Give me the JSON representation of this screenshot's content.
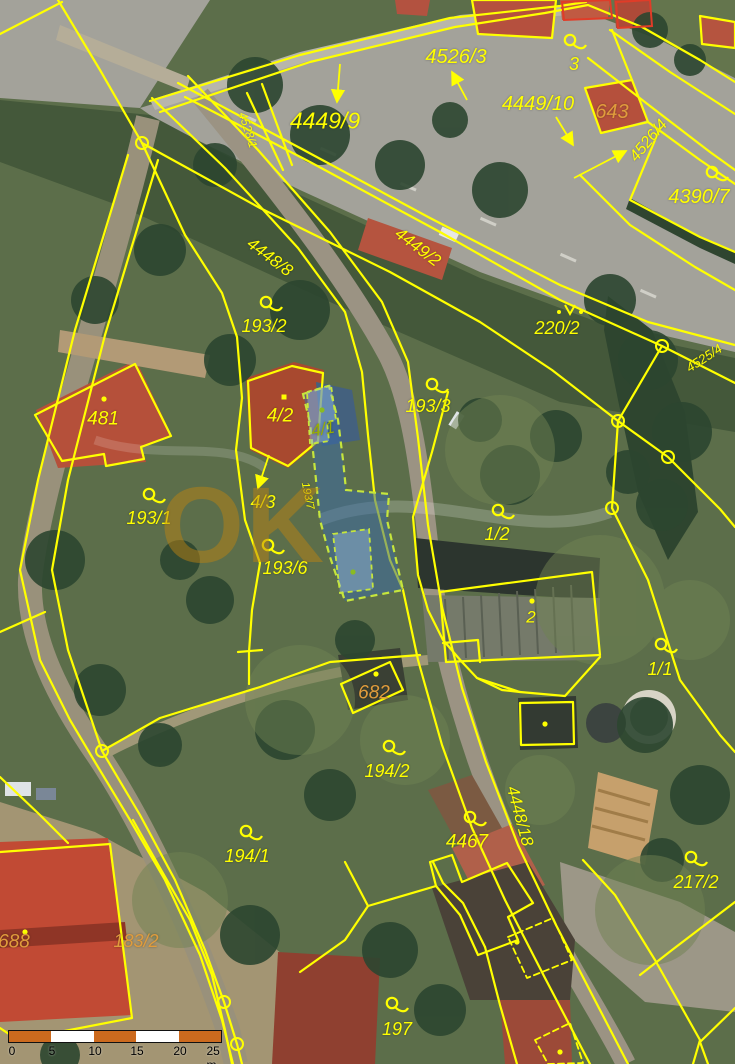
{
  "map": {
    "watermark": {
      "text": "OK"
    },
    "colors": {
      "parcel_line_yellow": "#ffff00",
      "label_yellow": "#ffff00",
      "label_orange": "#e09c3c",
      "label_green": "#9aae00",
      "highlight_outline_green": "#c6e63c",
      "highlight_fill_blue": "rgba(58,108,168,0.52)",
      "red_building_outline": "#e03c28",
      "scalebar_orange": "#cc6a1e"
    },
    "labels": [
      {
        "id": "4526-3",
        "text": "4526/3",
        "x": 456,
        "y": 57,
        "rot": 0,
        "size": 20,
        "color": "yellow"
      },
      {
        "id": "3",
        "text": "3",
        "x": 574,
        "y": 64,
        "rot": 0,
        "size": 18,
        "color": "yellow"
      },
      {
        "id": "4449-10",
        "text": "4449/10",
        "x": 538,
        "y": 104,
        "rot": 0,
        "size": 20,
        "color": "yellow"
      },
      {
        "id": "643",
        "text": "643",
        "x": 612,
        "y": 112,
        "rot": 0,
        "size": 20,
        "color": "orange"
      },
      {
        "id": "4526-4",
        "text": "4526/4",
        "x": 649,
        "y": 141,
        "rot": -50,
        "size": 16,
        "color": "yellow"
      },
      {
        "id": "4390-7",
        "text": "4390/7",
        "x": 699,
        "y": 197,
        "rot": 0,
        "size": 20,
        "color": "yellow"
      },
      {
        "id": "4449-9",
        "text": "4449/9",
        "x": 325,
        "y": 121,
        "rot": 0,
        "size": 23,
        "color": "yellow"
      },
      {
        "id": "4528-1",
        "text": "4528/1",
        "x": 248,
        "y": 130,
        "rot": 72,
        "size": 12,
        "color": "yellow"
      },
      {
        "id": "4448-8",
        "text": "4448/8",
        "x": 270,
        "y": 257,
        "rot": 37,
        "size": 17,
        "color": "yellow"
      },
      {
        "id": "4449-2",
        "text": "4449/2",
        "x": 418,
        "y": 247,
        "rot": 37,
        "size": 17,
        "color": "yellow"
      },
      {
        "id": "220-2",
        "text": "220/2",
        "x": 557,
        "y": 328,
        "rot": 0,
        "size": 18,
        "color": "yellow"
      },
      {
        "id": "193-2",
        "text": "193/2",
        "x": 264,
        "y": 326,
        "rot": 0,
        "size": 18,
        "color": "yellow"
      },
      {
        "id": "481",
        "text": "481",
        "x": 103,
        "y": 419,
        "rot": 0,
        "size": 19,
        "color": "yellow"
      },
      {
        "id": "4-2",
        "text": "4/2",
        "x": 280,
        "y": 416,
        "rot": 0,
        "size": 19,
        "color": "yellow"
      },
      {
        "id": "4-1",
        "text": "4/1",
        "x": 323,
        "y": 429,
        "rot": -10,
        "size": 17,
        "color": "green"
      },
      {
        "id": "4-3",
        "text": "4/3",
        "x": 263,
        "y": 502,
        "rot": 0,
        "size": 18,
        "color": "yellow"
      },
      {
        "id": "193-7",
        "text": "193/7",
        "x": 307,
        "y": 496,
        "rot": 78,
        "size": 11,
        "color": "yellow"
      },
      {
        "id": "193-1",
        "text": "193/1",
        "x": 149,
        "y": 518,
        "rot": 0,
        "size": 18,
        "color": "yellow"
      },
      {
        "id": "193-6",
        "text": "193/6",
        "x": 285,
        "y": 568,
        "rot": 0,
        "size": 18,
        "color": "yellow"
      },
      {
        "id": "193-3",
        "text": "193/3",
        "x": 428,
        "y": 406,
        "rot": 0,
        "size": 18,
        "color": "yellow"
      },
      {
        "id": "1-2",
        "text": "1/2",
        "x": 497,
        "y": 534,
        "rot": 0,
        "size": 18,
        "color": "yellow"
      },
      {
        "id": "2",
        "text": "2",
        "x": 531,
        "y": 617,
        "rot": 0,
        "size": 17,
        "color": "yellow"
      },
      {
        "id": "1-1",
        "text": "1/1",
        "x": 660,
        "y": 669,
        "rot": 0,
        "size": 18,
        "color": "yellow"
      },
      {
        "id": "682",
        "text": "682",
        "x": 374,
        "y": 693,
        "rot": 0,
        "size": 19,
        "color": "orange"
      },
      {
        "id": "194-2",
        "text": "194/2",
        "x": 387,
        "y": 771,
        "rot": 0,
        "size": 18,
        "color": "yellow"
      },
      {
        "id": "4467",
        "text": "4467",
        "x": 467,
        "y": 842,
        "rot": 0,
        "size": 19,
        "color": "yellow"
      },
      {
        "id": "4448-18",
        "text": "4448/18",
        "x": 520,
        "y": 816,
        "rot": 75,
        "size": 17,
        "color": "yellow"
      },
      {
        "id": "194-1",
        "text": "194/1",
        "x": 247,
        "y": 856,
        "rot": 0,
        "size": 18,
        "color": "yellow"
      },
      {
        "id": "217-2",
        "text": "217/2",
        "x": 696,
        "y": 882,
        "rot": 0,
        "size": 18,
        "color": "yellow"
      },
      {
        "id": "688",
        "text": "688",
        "x": 14,
        "y": 942,
        "rot": 0,
        "size": 19,
        "color": "orange"
      },
      {
        "id": "183-2",
        "text": "183/2",
        "x": 136,
        "y": 941,
        "rot": 0,
        "size": 18,
        "color": "orange"
      },
      {
        "id": "197",
        "text": "197",
        "x": 397,
        "y": 1029,
        "rot": 0,
        "size": 18,
        "color": "yellow"
      },
      {
        "id": "4525-4",
        "text": "4525/4",
        "x": 704,
        "y": 358,
        "rot": -33,
        "size": 13,
        "color": "yellow"
      }
    ],
    "symbols": [
      {
        "type": "loop",
        "x": 570,
        "y": 40
      },
      {
        "type": "loop",
        "x": 712,
        "y": 172
      },
      {
        "type": "loop",
        "x": 266,
        "y": 302
      },
      {
        "type": "loop",
        "x": 432,
        "y": 384
      },
      {
        "type": "loop",
        "x": 149,
        "y": 494
      },
      {
        "type": "loop",
        "x": 268,
        "y": 545
      },
      {
        "type": "loop",
        "x": 498,
        "y": 510
      },
      {
        "type": "loop",
        "x": 661,
        "y": 644
      },
      {
        "type": "loop",
        "x": 389,
        "y": 746
      },
      {
        "type": "loop",
        "x": 470,
        "y": 817
      },
      {
        "type": "loop",
        "x": 246,
        "y": 831
      },
      {
        "type": "loop",
        "x": 691,
        "y": 857
      },
      {
        "type": "loop",
        "x": 392,
        "y": 1003
      },
      {
        "type": "vertex",
        "x": 142,
        "y": 143
      },
      {
        "type": "vertex",
        "x": 662,
        "y": 346
      },
      {
        "type": "vertex",
        "x": 618,
        "y": 421
      },
      {
        "type": "vertex",
        "x": 668,
        "y": 457
      },
      {
        "type": "vertex",
        "x": 612,
        "y": 508
      },
      {
        "type": "vertex",
        "x": 102,
        "y": 751
      },
      {
        "type": "vertex",
        "x": 224,
        "y": 1002
      },
      {
        "type": "vertex",
        "x": 237,
        "y": 1044
      },
      {
        "type": "dot",
        "x": 104,
        "y": 399
      },
      {
        "type": "dot",
        "x": 532,
        "y": 601
      },
      {
        "type": "dot",
        "x": 376,
        "y": 674
      },
      {
        "type": "dot",
        "x": 545,
        "y": 724
      },
      {
        "type": "dot",
        "x": 25,
        "y": 932
      },
      {
        "type": "dot",
        "x": 517,
        "y": 942
      },
      {
        "type": "dot",
        "x": 560,
        "y": 1052
      },
      {
        "type": "sqdot",
        "x": 284,
        "y": 397
      },
      {
        "type": "greendot",
        "x": 322,
        "y": 410
      },
      {
        "type": "greendot",
        "x": 353,
        "y": 572
      },
      {
        "type": "vsym",
        "x": 570,
        "y": 309
      }
    ],
    "arrows": [
      {
        "x1": 340,
        "y1": 64,
        "x2": 337,
        "y2": 102
      },
      {
        "x1": 467,
        "y1": 100,
        "x2": 452,
        "y2": 72
      },
      {
        "x1": 556,
        "y1": 117,
        "x2": 573,
        "y2": 145
      },
      {
        "x1": 574,
        "y1": 178,
        "x2": 626,
        "y2": 151
      },
      {
        "x1": 269,
        "y1": 455,
        "x2": 258,
        "y2": 488
      }
    ]
  },
  "scalebar": {
    "ticks": [
      "0",
      "5",
      "10",
      "15",
      "20",
      "25 m"
    ]
  }
}
